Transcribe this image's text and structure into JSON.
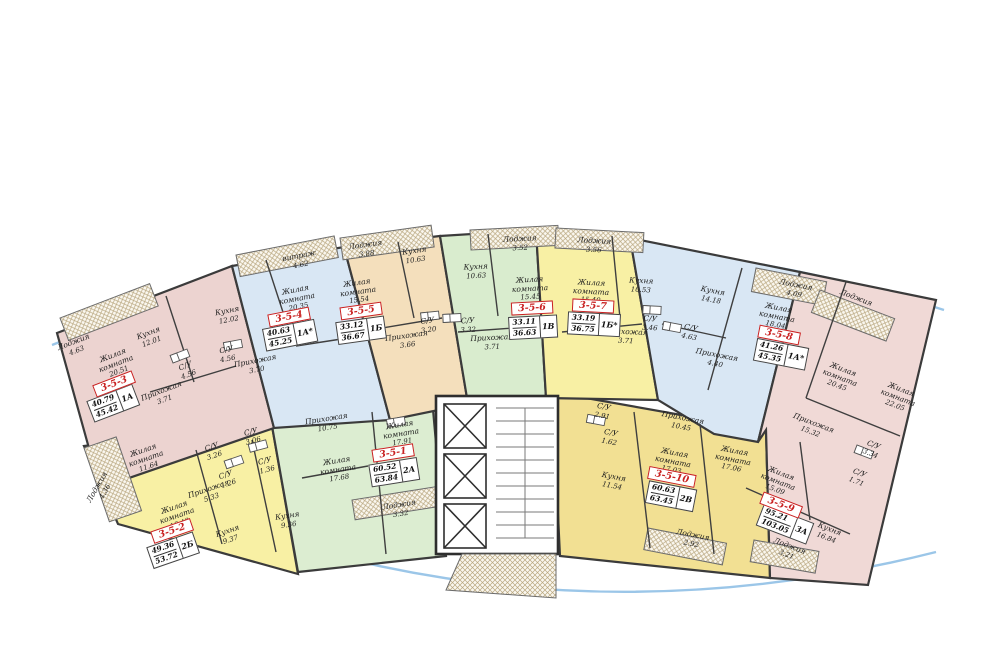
{
  "plan_name": "floor-plan",
  "colors": {
    "wall": "#3b3b3b",
    "label_red": "#c92121",
    "glazing_blue": "#9bc6e8",
    "unit_pink": "#ecd3d0",
    "unit_pink_light": "#f0d9d6",
    "unit_blue": "#d9e7f4",
    "unit_tan": "#f4dfbc",
    "unit_green": "#d9ecce",
    "unit_yellow": "#f8f0a4",
    "unit_gold": "#f2e093"
  },
  "apartments": [
    {
      "id": "3-5-1",
      "type": "2А",
      "area_living": "60.52",
      "area_total": "63.84",
      "rooms": [
        {
          "name": "Прихожая",
          "area": "10.75"
        },
        {
          "name": "Жилая комната",
          "area": "17.91"
        },
        {
          "name": "Жилая комната",
          "area": "17.68"
        },
        {
          "name": "Кухня",
          "area": "9.36"
        },
        {
          "name": "Лоджия",
          "area": "3.32"
        },
        {
          "name": "С/У",
          "area": "3.06"
        },
        {
          "name": "С/У",
          "area": "1.36"
        }
      ]
    },
    {
      "id": "3-5-2",
      "type": "2Б",
      "area_living": "49.36",
      "area_total": "53.72",
      "rooms": [
        {
          "name": "Жилая комната",
          "area": "11.64"
        },
        {
          "name": "Жилая комната",
          "area": "18.48"
        },
        {
          "name": "Кухня",
          "area": "9.37"
        },
        {
          "name": "Лоджия",
          "area": "4.36"
        },
        {
          "name": "Прихожая",
          "area": "5.33"
        },
        {
          "name": "С/У",
          "area": "3.26"
        },
        {
          "name": "С/У",
          "area": "1.26"
        }
      ]
    },
    {
      "id": "3-5-3",
      "type": "1А",
      "area_living": "40.79",
      "area_total": "45.42",
      "rooms": [
        {
          "name": "Лоджия",
          "area": "4.63"
        },
        {
          "name": "Жилая комната",
          "area": "20.51"
        },
        {
          "name": "Кухня",
          "area": "12.01"
        },
        {
          "name": "С/У",
          "area": "4.56"
        },
        {
          "name": "Прихожая",
          "area": "3.71"
        }
      ]
    },
    {
      "id": "3-5-4",
      "type": "1А*",
      "area_living": "40.63",
      "area_total": "45.25",
      "rooms": [
        {
          "name": "витраж",
          "area": "4.62"
        },
        {
          "name": "Жилая комната",
          "area": "20.35"
        },
        {
          "name": "Кухня",
          "area": "12.02"
        },
        {
          "name": "С/У",
          "area": "4.56"
        },
        {
          "name": "Прихожая",
          "area": "3.70"
        }
      ]
    },
    {
      "id": "3-5-5",
      "type": "1Б",
      "area_living": "33.12",
      "area_total": "36.67",
      "rooms": [
        {
          "name": "Лоджия",
          "area": "3.88"
        },
        {
          "name": "Жилая комната",
          "area": "15.54"
        },
        {
          "name": "Кухня",
          "area": "10.63"
        },
        {
          "name": "С/У",
          "area": "3.20"
        },
        {
          "name": "Прихожая",
          "area": "3.66"
        }
      ]
    },
    {
      "id": "3-5-6",
      "type": "1В",
      "area_living": "33.11",
      "area_total": "36.63",
      "rooms": [
        {
          "name": "Лоджия",
          "area": "3.52"
        },
        {
          "name": "Кухня",
          "area": "10.63"
        },
        {
          "name": "Жилая комната",
          "area": "15.45"
        },
        {
          "name": "С/У",
          "area": "3.32"
        },
        {
          "name": "Прихожая",
          "area": "3.71"
        }
      ]
    },
    {
      "id": "3-5-7",
      "type": "1Б*",
      "area_living": "33.19",
      "area_total": "36.75",
      "rooms": [
        {
          "name": "Лоджия",
          "area": "3.56"
        },
        {
          "name": "Жилая комната",
          "area": "15.40"
        },
        {
          "name": "Кухня",
          "area": "10.53"
        },
        {
          "name": "С/У",
          "area": "3.46"
        },
        {
          "name": "Прихожая",
          "area": "3.71"
        }
      ]
    },
    {
      "id": "3-5-8",
      "type": "1А*",
      "area_living": "41.26",
      "area_total": "45.35",
      "rooms": [
        {
          "name": "Лоджия",
          "area": "4.09"
        },
        {
          "name": "Кухня",
          "area": "14.18"
        },
        {
          "name": "С/У",
          "area": "4.63"
        },
        {
          "name": "Прихожая",
          "area": "4.40"
        },
        {
          "name": "Жилая комната",
          "area": "18.04"
        }
      ]
    },
    {
      "id": "3-5-9",
      "type": "3А",
      "area_living": "95.21",
      "area_total": "103.05",
      "rooms": [
        {
          "name": "Лоджия",
          "area": ""
        },
        {
          "name": "Жилая комната",
          "area": "20.45"
        },
        {
          "name": "Жилая комната",
          "area": "22.05"
        },
        {
          "name": "Прихожая",
          "area": "15.32"
        },
        {
          "name": "С/У",
          "area": "3.34"
        },
        {
          "name": "С/У",
          "area": "1.71"
        },
        {
          "name": "Жилая комната",
          "area": "15.09"
        },
        {
          "name": "Кухня",
          "area": "16.84"
        },
        {
          "name": "Лоджия",
          "area": "3.21"
        }
      ]
    },
    {
      "id": "3-5-10",
      "type": "2В",
      "area_living": "60.63",
      "area_total": "63.45",
      "rooms": [
        {
          "name": "С/У",
          "area": "2.91"
        },
        {
          "name": "С/У",
          "area": "1.62"
        },
        {
          "name": "Кухня",
          "area": "11.54"
        },
        {
          "name": "Прихожая",
          "area": "10.45"
        },
        {
          "name": "Жилая комната",
          "area": "17.03"
        },
        {
          "name": "Жилая комната",
          "area": "17.06"
        },
        {
          "name": "Лоджия",
          "area": "2.92"
        }
      ]
    }
  ]
}
